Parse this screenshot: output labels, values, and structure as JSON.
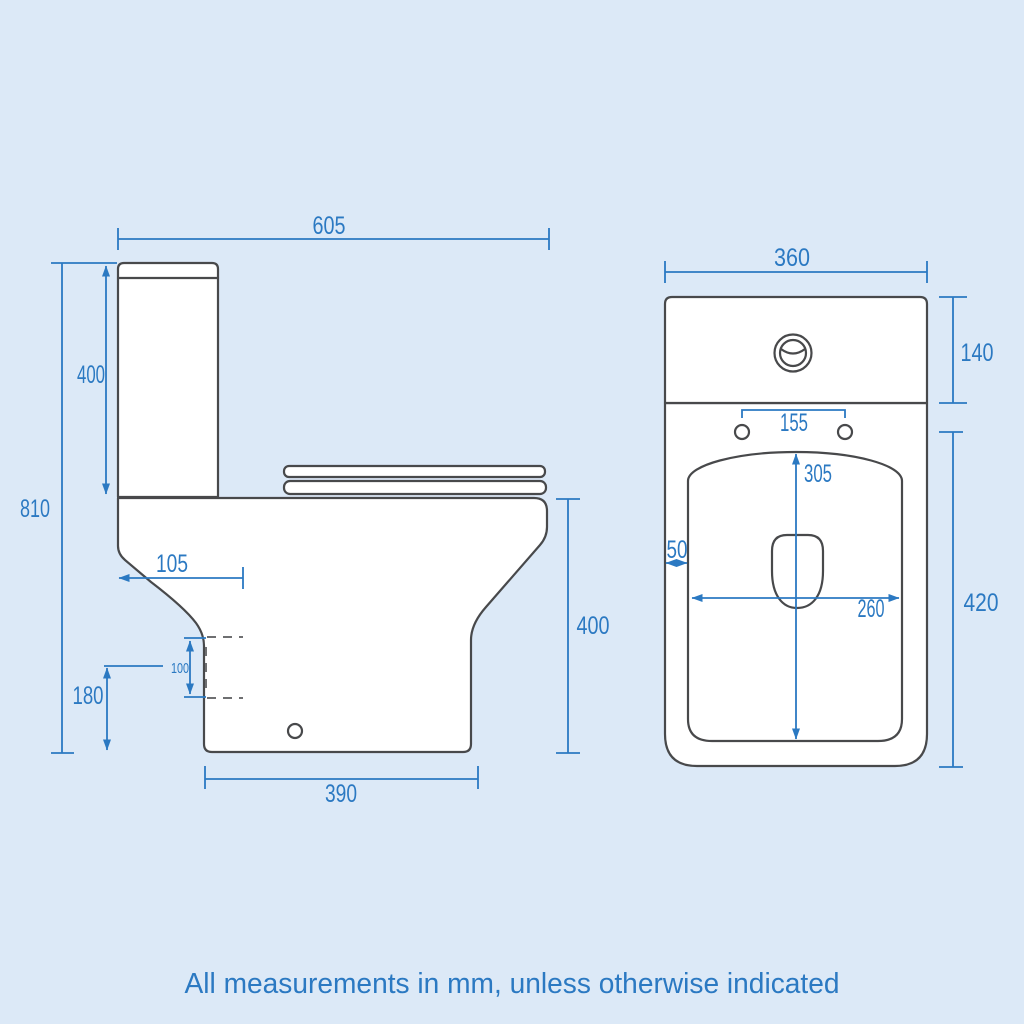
{
  "palette": {
    "background": "#dce9f7",
    "dimension_blue": "#2b79c2",
    "outline_gray": "#48494b",
    "product_fill": "#ffffff"
  },
  "side_view": {
    "dims": {
      "overall_depth": "605",
      "cistern_height": "400",
      "overall_height": "810",
      "front_projection": "105",
      "outlet_height": "180",
      "outlet_size": "100",
      "base_depth": "390",
      "pan_height": "400"
    }
  },
  "front_view": {
    "dims": {
      "overall_width": "360",
      "cistern_height": "140",
      "hinge_centres": "155",
      "bowl_inner_length": "305",
      "rim_width": "50",
      "bowl_inner_width": "260",
      "pan_height": "420"
    }
  },
  "footer": {
    "note": "All measurements in mm, unless otherwise indicated"
  }
}
